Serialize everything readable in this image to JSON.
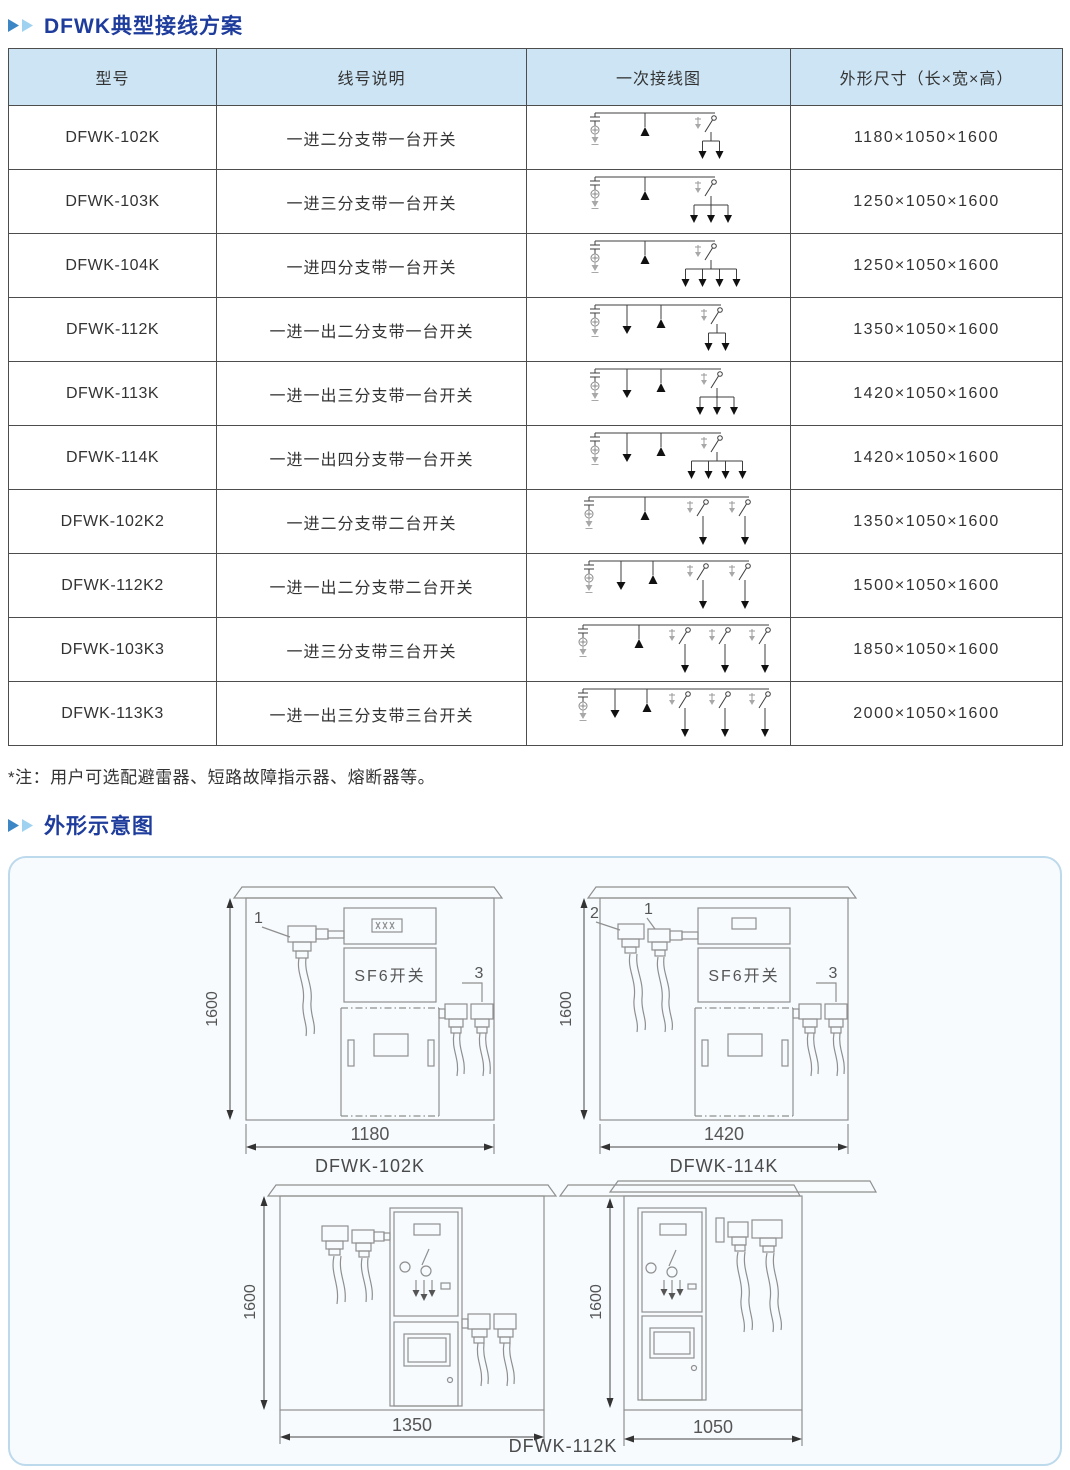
{
  "page": {
    "section1_title": "DFWK典型接线方案",
    "section2_title": "外形示意图",
    "note": "*注：用户可选配避雷器、短路故障指示器、熔断器等。"
  },
  "table": {
    "headers": [
      "型号",
      "线号说明",
      "一次接线图",
      "外形尺寸（长×宽×高）"
    ],
    "rows": [
      {
        "model": "DFWK-102K",
        "desc": "一进二分支带一台开关",
        "dims": "1180×1050×1600",
        "diagram": {
          "out": 0,
          "sw": 1,
          "br": 2
        }
      },
      {
        "model": "DFWK-103K",
        "desc": "一进三分支带一台开关",
        "dims": "1250×1050×1600",
        "diagram": {
          "out": 0,
          "sw": 1,
          "br": 3
        }
      },
      {
        "model": "DFWK-104K",
        "desc": "一进四分支带一台开关",
        "dims": "1250×1050×1600",
        "diagram": {
          "out": 0,
          "sw": 1,
          "br": 4
        }
      },
      {
        "model": "DFWK-112K",
        "desc": "一进一出二分支带一台开关",
        "dims": "1350×1050×1600",
        "diagram": {
          "out": 1,
          "sw": 1,
          "br": 2
        }
      },
      {
        "model": "DFWK-113K",
        "desc": "一进一出三分支带一台开关",
        "dims": "1420×1050×1600",
        "diagram": {
          "out": 1,
          "sw": 1,
          "br": 3
        }
      },
      {
        "model": "DFWK-114K",
        "desc": "一进一出四分支带一台开关",
        "dims": "1420×1050×1600",
        "diagram": {
          "out": 1,
          "sw": 1,
          "br": 4
        }
      },
      {
        "model": "DFWK-102K2",
        "desc": "一进二分支带二台开关",
        "dims": "1350×1050×1600",
        "diagram": {
          "out": 0,
          "sw": 2,
          "br": 1
        }
      },
      {
        "model": "DFWK-112K2",
        "desc": "一进一出二分支带二台开关",
        "dims": "1500×1050×1600",
        "diagram": {
          "out": 1,
          "sw": 2,
          "br": 1
        }
      },
      {
        "model": "DFWK-103K3",
        "desc": "一进三分支带三台开关",
        "dims": "1850×1050×1600",
        "diagram": {
          "out": 0,
          "sw": 3,
          "br": 1
        }
      },
      {
        "model": "DFWK-113K3",
        "desc": "一进一出三分支带三台开关",
        "dims": "2000×1050×1600",
        "diagram": {
          "out": 1,
          "sw": 3,
          "br": 1
        }
      }
    ]
  },
  "drawings": {
    "front_102k": {
      "caption": "DFWK-102K",
      "height_dim": "1600",
      "width_dim": "1180",
      "switch_label": "SF6开关",
      "callout_1": "1",
      "callout_3": "3"
    },
    "front_114k": {
      "caption": "DFWK-114K",
      "height_dim": "1600",
      "width_dim": "1420",
      "switch_label": "SF6开关",
      "callout_1": "1",
      "callout_2": "2",
      "callout_3": "3"
    },
    "front_112k": {
      "height_dim": "1600",
      "width_dim": "1350"
    },
    "side_112k": {
      "height_dim": "1600",
      "width_dim": "1050"
    },
    "bottom_caption": "DFWK-112K"
  },
  "colors": {
    "title_blue": "#1e3c9c",
    "arrow_dark_blue": "#3c86c6",
    "arrow_light_blue": "#9fd2f0",
    "table_header_bg": "#cce4f4",
    "panel_border": "#bdd9ec",
    "panel_bg": "#f7fbfe",
    "drawing_line": "#8f8f8f"
  }
}
